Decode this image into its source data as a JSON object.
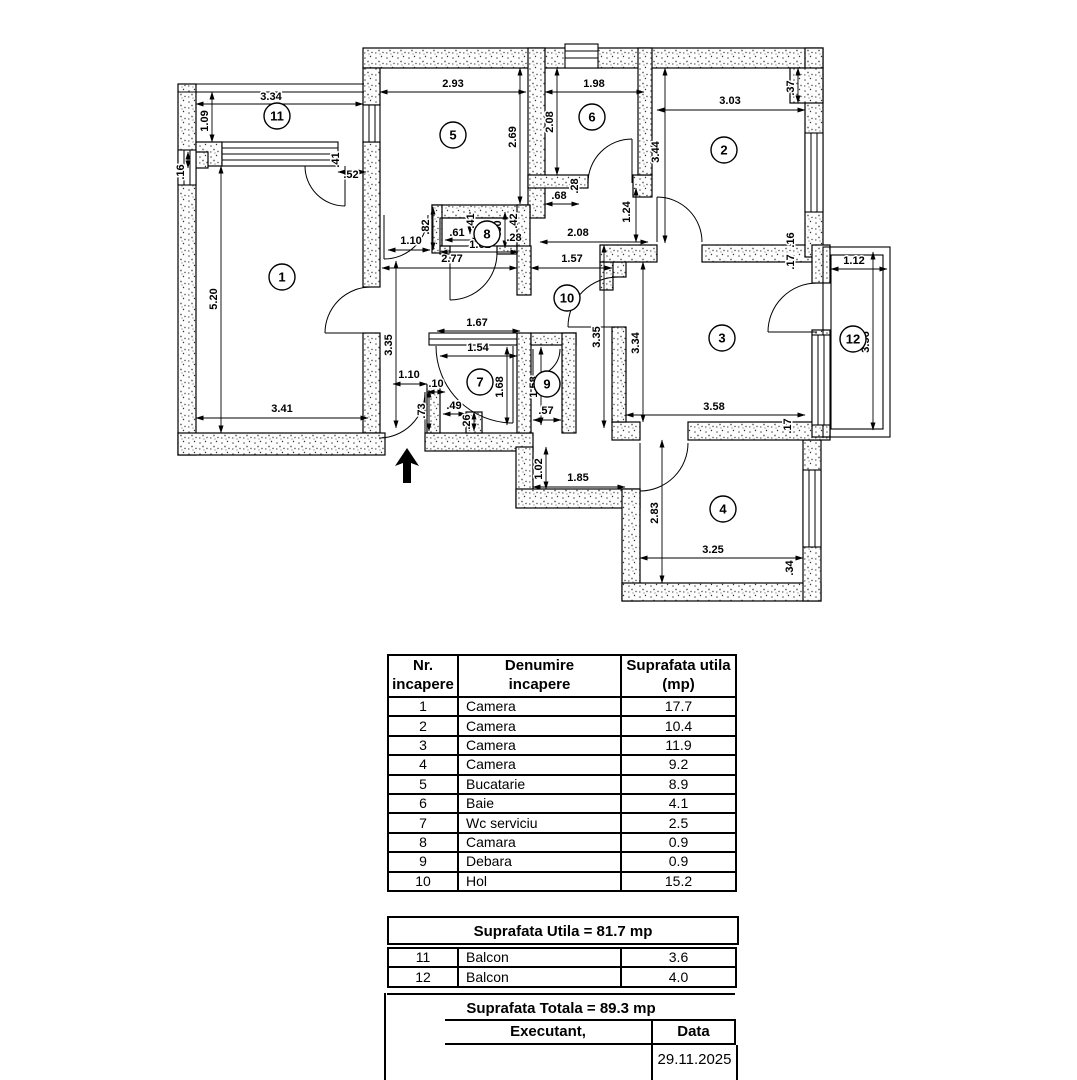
{
  "plan": {
    "north_arrow": "entry-direction-arrow",
    "rooms": [
      {
        "n": "1",
        "x": 282,
        "y": 277
      },
      {
        "n": "2",
        "x": 724,
        "y": 150
      },
      {
        "n": "3",
        "x": 722,
        "y": 338
      },
      {
        "n": "4",
        "x": 723,
        "y": 509
      },
      {
        "n": "5",
        "x": 453,
        "y": 135
      },
      {
        "n": "6",
        "x": 592,
        "y": 117
      },
      {
        "n": "7",
        "x": 480,
        "y": 382
      },
      {
        "n": "8",
        "x": 487,
        "y": 234
      },
      {
        "n": "9",
        "x": 547,
        "y": 384
      },
      {
        "n": "10",
        "x": 567,
        "y": 298
      },
      {
        "n": "11",
        "x": 277,
        "y": 116
      },
      {
        "n": "12",
        "x": 853,
        "y": 339
      }
    ],
    "dims": [
      {
        "t": "3.34",
        "x": 271,
        "y": 100,
        "l": [
          196,
          104,
          363,
          104
        ]
      },
      {
        "t": "1.09",
        "x": 208,
        "y": 121,
        "r": 1,
        "l": [
          212,
          92,
          212,
          142
        ]
      },
      {
        "t": ".16",
        "x": 184,
        "y": 172,
        "r": 1,
        "l": [
          188,
          152,
          188,
          168
        ]
      },
      {
        "t": "5.20",
        "x": 217,
        "y": 299,
        "r": 1,
        "l": [
          221,
          166,
          221,
          433
        ]
      },
      {
        "t": "3.41",
        "x": 282,
        "y": 412,
        "l": [
          196,
          418,
          368,
          418
        ]
      },
      {
        "t": ".41",
        "x": 339,
        "y": 160,
        "r": 1
      },
      {
        "t": ".52",
        "x": 351,
        "y": 178,
        "l": [
          338,
          172,
          366,
          172
        ]
      },
      {
        "t": "2.93",
        "x": 453,
        "y": 87,
        "l": [
          380,
          92,
          526,
          92
        ]
      },
      {
        "t": "2.69",
        "x": 516,
        "y": 137,
        "r": 1,
        "l": [
          520,
          68,
          520,
          204
        ]
      },
      {
        "t": "1.98",
        "x": 594,
        "y": 87,
        "l": [
          545,
          92,
          644,
          92
        ]
      },
      {
        "t": "2.08",
        "x": 553,
        "y": 122,
        "r": 1,
        "l": [
          557,
          68,
          557,
          175
        ]
      },
      {
        "t": "3.03",
        "x": 730,
        "y": 104,
        "l": [
          657,
          110,
          805,
          110
        ]
      },
      {
        "t": ".37",
        "x": 794,
        "y": 88,
        "r": 1,
        "l": [
          798,
          68,
          798,
          103
        ]
      },
      {
        "t": "3.44",
        "x": 659,
        "y": 152,
        "r": 1,
        "l": [
          665,
          68,
          665,
          243
        ]
      },
      {
        "t": "1.24",
        "x": 630,
        "y": 212,
        "r": 1,
        "l": [
          636,
          188,
          636,
          242
        ]
      },
      {
        "t": ".68",
        "x": 559,
        "y": 199,
        "l": [
          545,
          204,
          579,
          204
        ]
      },
      {
        "t": ".28",
        "x": 578,
        "y": 186,
        "r": 1
      },
      {
        "t": "2.08",
        "x": 578,
        "y": 236,
        "l": [
          540,
          242,
          648,
          242
        ]
      },
      {
        "t": "2.77",
        "x": 452,
        "y": 262,
        "l": [
          382,
          268,
          517,
          268
        ]
      },
      {
        "t": "1.57",
        "x": 572,
        "y": 262,
        "l": [
          531,
          268,
          612,
          268
        ]
      },
      {
        "t": "1.10",
        "x": 411,
        "y": 244,
        "l": [
          388,
          250,
          430,
          250
        ]
      },
      {
        "t": ".82",
        "x": 429,
        "y": 227,
        "r": 1,
        "l": [
          433,
          207,
          433,
          250
        ]
      },
      {
        "t": ".61",
        "x": 457,
        "y": 236,
        "l": [
          445,
          240,
          480,
          240
        ]
      },
      {
        "t": "1.61",
        "x": 480,
        "y": 248,
        "l": [
          440,
          252,
          518,
          252
        ]
      },
      {
        "t": ".41",
        "x": 474,
        "y": 221,
        "r": 1,
        "l": [
          470,
          212,
          470,
          234
        ]
      },
      {
        "t": ".80",
        "x": 501,
        "y": 228,
        "r": 1,
        "l": [
          505,
          212,
          505,
          248
        ]
      },
      {
        "t": ".42",
        "x": 517,
        "y": 221,
        "r": 1
      },
      {
        "t": ".28",
        "x": 514,
        "y": 241
      },
      {
        "t": "3.35",
        "x": 392,
        "y": 345,
        "r": 1,
        "l": [
          396,
          261,
          396,
          428
        ]
      },
      {
        "t": "3.35",
        "x": 600,
        "y": 337,
        "r": 1,
        "l": [
          604,
          245,
          604,
          428
        ]
      },
      {
        "t": "3.34",
        "x": 639,
        "y": 343,
        "r": 1,
        "l": [
          643,
          262,
          643,
          422
        ]
      },
      {
        "t": "3.58",
        "x": 714,
        "y": 410,
        "l": [
          626,
          415,
          805,
          415
        ]
      },
      {
        "t": "1.12",
        "x": 854,
        "y": 264,
        "l": [
          831,
          269,
          887,
          269
        ]
      },
      {
        "t": "3.56",
        "x": 869,
        "y": 342,
        "r": 1,
        "l": [
          873,
          252,
          873,
          430
        ]
      },
      {
        "t": "2.83",
        "x": 658,
        "y": 513,
        "r": 1,
        "l": [
          662,
          440,
          662,
          583
        ]
      },
      {
        "t": "3.25",
        "x": 713,
        "y": 553,
        "l": [
          640,
          558,
          803,
          558
        ]
      },
      {
        "t": "1.02",
        "x": 542,
        "y": 469,
        "r": 1,
        "l": [
          546,
          447,
          546,
          489
        ]
      },
      {
        "t": "1.85",
        "x": 578,
        "y": 481,
        "l": [
          533,
          487,
          625,
          487
        ]
      },
      {
        "t": "1.67",
        "x": 477,
        "y": 326,
        "l": [
          437,
          331,
          520,
          331
        ]
      },
      {
        "t": "1.54",
        "x": 478,
        "y": 351,
        "l": [
          440,
          356,
          517,
          356
        ]
      },
      {
        "t": "1.68",
        "x": 503,
        "y": 387,
        "r": 1,
        "l": [
          507,
          347,
          507,
          425
        ]
      },
      {
        "t": "1.58",
        "x": 537,
        "y": 387,
        "r": 1,
        "l": [
          541,
          347,
          541,
          425
        ]
      },
      {
        "t": ".57",
        "x": 546,
        "y": 414,
        "l": [
          533,
          420,
          561,
          420
        ]
      },
      {
        "t": "1.10",
        "x": 409,
        "y": 378,
        "l": [
          393,
          384,
          427,
          384
        ]
      },
      {
        "t": ".10",
        "x": 436,
        "y": 387,
        "l": [
          427,
          392,
          445,
          392
        ]
      },
      {
        "t": ".73",
        "x": 425,
        "y": 411,
        "r": 1,
        "l": [
          429,
          390,
          429,
          431
        ]
      },
      {
        "t": ".49",
        "x": 454,
        "y": 409,
        "l": [
          443,
          414,
          466,
          414
        ]
      },
      {
        "t": ".26",
        "x": 470,
        "y": 422,
        "r": 1,
        "l": [
          474,
          412,
          474,
          431
        ]
      },
      {
        "t": ".16",
        "x": 794,
        "y": 240,
        "r": 1
      },
      {
        "t": ".17",
        "x": 794,
        "y": 262,
        "r": 1
      },
      {
        "t": ".17",
        "x": 791,
        "y": 426,
        "r": 1
      },
      {
        "t": ".34",
        "x": 793,
        "y": 568,
        "r": 1
      }
    ]
  },
  "table": {
    "h": {
      "c1a": "Nr.",
      "c1b": "incapere",
      "c2a": "Denumire",
      "c2b": "incapere",
      "c3a": "Suprafata utila",
      "c3b": "(mp)"
    },
    "rows": [
      [
        "1",
        "Camera",
        "17.7"
      ],
      [
        "2",
        "Camera",
        "10.4"
      ],
      [
        "3",
        "Camera",
        "11.9"
      ],
      [
        "4",
        "Camera",
        "9.2"
      ],
      [
        "5",
        "Bucatarie",
        "8.9"
      ],
      [
        "6",
        "Baie",
        "4.1"
      ],
      [
        "7",
        "Wc serviciu",
        "2.5"
      ],
      [
        "8",
        "Camara",
        "0.9"
      ],
      [
        "9",
        "Debara",
        "0.9"
      ],
      [
        "10",
        "Hol",
        "15.2"
      ]
    ],
    "subtotal_label": "Suprafata Utila = 81.7 mp",
    "balconies": [
      [
        "11",
        "Balcon",
        "3.6"
      ],
      [
        "12",
        "Balcon",
        "4.0"
      ]
    ],
    "total_label": "Suprafata Totala = 89.3 mp"
  },
  "footer": {
    "executant": "Executant,",
    "data_label": "Data",
    "date": "29.11.2025"
  }
}
